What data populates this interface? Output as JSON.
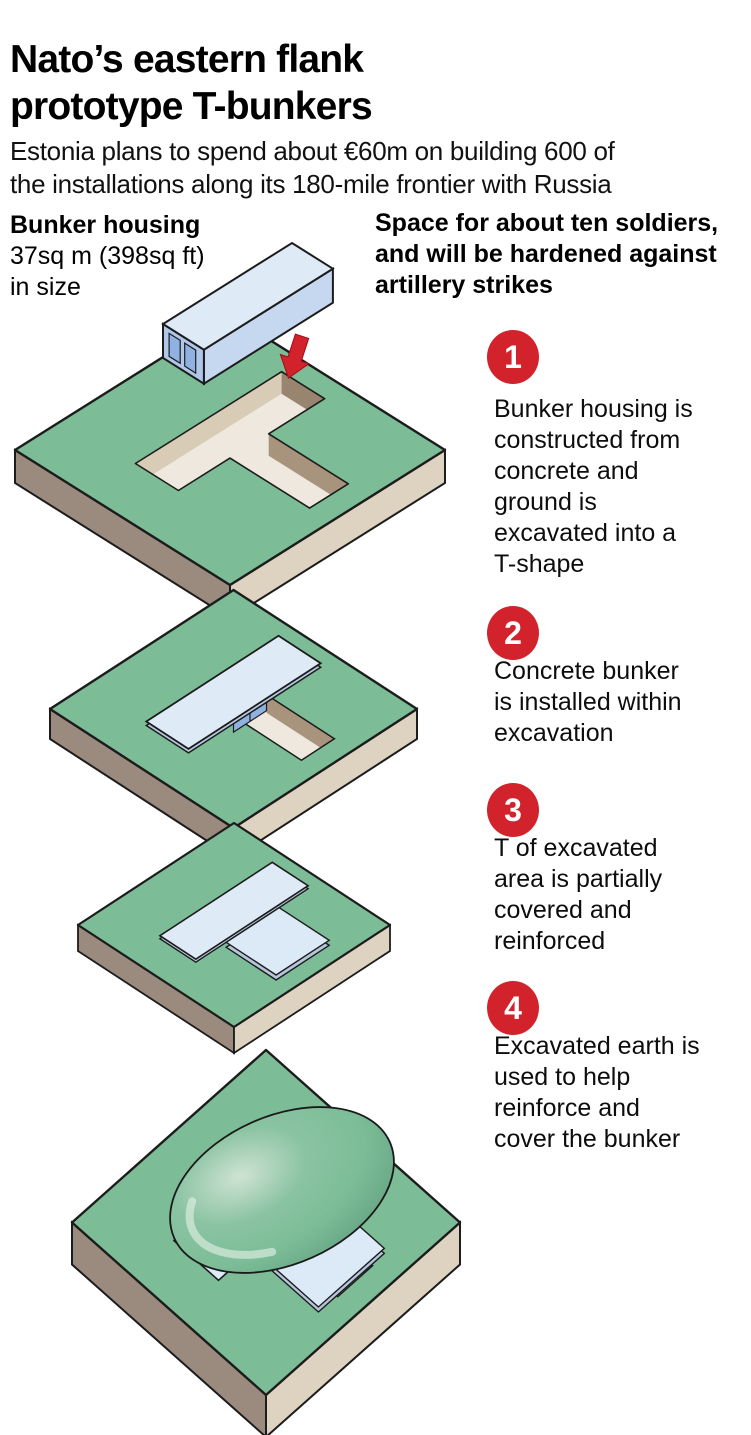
{
  "header": {
    "title": "Nato’s eastern flank\nprototype T-bunkers",
    "subtitle": "Estonia plans to spend about €60m on building 600 of\nthe installations along its 180-mile frontier with Russia"
  },
  "annotations": {
    "bunker_housing": {
      "heading": "Bunker housing",
      "line2": "37sq m (398sq ft)",
      "line3": "in size"
    },
    "capacity": "Space for about ten soldiers,\nand will be hardened against\nartillery strikes"
  },
  "steps": [
    {
      "number": "1",
      "text": "Bunker housing is\nconstructed from\nconcrete and\nground is\nexcavated into a\nT-shape"
    },
    {
      "number": "2",
      "text": "Concrete bunker\nis installed within\nexcavation"
    },
    {
      "number": "3",
      "text": "T of excavated\narea is partially\ncovered and\nreinforced"
    },
    {
      "number": "4",
      "text": "Excavated earth is\nused to help\nreinforce and\ncover the bunker"
    }
  ],
  "icons": [
    "down-arrow-icon",
    "t-excavation",
    "bunker-box",
    "bunker-door",
    "cover-plate",
    "earth-mound"
  ],
  "colors": {
    "accent_red": "#d2232d",
    "grass_green": "#7cbd97",
    "slab_side_dark": "#9b8a7e",
    "slab_side_light": "#ded3c1",
    "pit_wall_dark": "#98846f",
    "pit_wall_light": "#d8ccb6",
    "pit_floor": "#eee8de",
    "bunker_top_blue": "#dfeaf7",
    "bunker_side_blue": "#c6d8ef",
    "door_blue": "#8fb2e2",
    "outline": "#1c1c1c"
  }
}
